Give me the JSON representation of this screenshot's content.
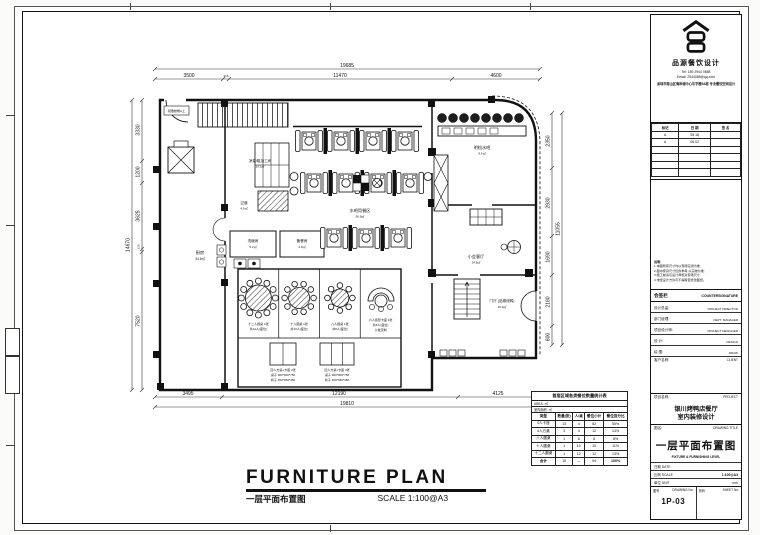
{
  "title_block": {
    "brand": {
      "name": "品源餐饮设计",
      "tel": "Tel: 189 2944 0888",
      "email": "Email: 2944088@qq.com",
      "address": "深圳市南山区海岸城中心写字楼5A栋 专业餐饮空间设计"
    },
    "revisions": {
      "headers": [
        "标记",
        "日 期",
        "签 名"
      ],
      "rows": [
        [
          "A",
          "05.18",
          ""
        ],
        [
          "A",
          "06.02",
          ""
        ]
      ]
    },
    "notes_title": "说明:",
    "notes": [
      "1.本图所有尺寸均以现场实测为准;",
      "2.图中家具尺寸仅供参考,以实物为准;",
      "3.施工前请与设计师核对现场尺寸;",
      "4.未经设计方许可不得擅自修改图纸。"
    ],
    "countersign": {
      "cn": "会签栏",
      "en": "COUNTERSIGNATURE"
    },
    "sign_rows": [
      [
        "设计总监:",
        "PROJECT DIRECTOR"
      ],
      [
        "部门经理:",
        "DEPT. MANAGER"
      ],
      [
        "项目设计师:",
        "PROJECT DESIGNER"
      ],
      [
        "设 计:",
        "DESIGN"
      ],
      [
        "绘 图:",
        "DRAW"
      ]
    ],
    "client_row": {
      "cn": "客户名称:",
      "en": "CLIENT"
    },
    "project_row": {
      "cn": "项目名称:",
      "en": "PROJECT"
    },
    "project_name_line1": "银川烤鸭店餐厅",
    "project_name_line2": "室内装修设计",
    "drawing_title_row": {
      "cn": "图名:",
      "en": "DRAWING TITLE"
    },
    "drawing_title_cn": "一层平面布置图",
    "drawing_title_en": "FIXTURE & FURNISHING LEVEL",
    "meta": [
      {
        "label": "日期 DATE",
        "value": ""
      },
      {
        "label": "比例 SCALE",
        "value": "1:100@A3"
      },
      {
        "label": "单位 UNIT",
        "value": "mm"
      }
    ],
    "drawing_no": {
      "cn": "图号",
      "en": "DRAWING No.",
      "value": "1P-03"
    },
    "sheet_no": {
      "cn": "页码",
      "en": "SHEET No.",
      "value": ""
    }
  },
  "footer": {
    "title": "FURNITURE PLAN",
    "subtitle_cn": "一层平面布置图",
    "scale": "SCALE  1:100@A3"
  },
  "plan": {
    "labels": {
      "stair_note": "疏散楼梯A上",
      "kitchen": "厨房",
      "kitchen_area": "34.6㎡",
      "cold": "凉菜/粗加工间",
      "cold_area": "10.1㎡",
      "corridor": "过道",
      "corridor_area": "4.6㎡",
      "dish": "洗碗间",
      "dish_area": "5.2㎡",
      "pantry": "备餐间",
      "pantry_area": "4.8㎡",
      "dining": "水吧用餐区",
      "dining_area": "56.9㎡",
      "bar": "明档水吧",
      "bar_area": "9.6㎡",
      "lounge": "小会客厅",
      "lounge_area": "14.6㎡",
      "foyer": "门厅 (品源烧鸭)",
      "foyer_area": "16.9㎡"
    },
    "dims": {
      "top_total": "19685",
      "top_segs": [
        "3500",
        "315",
        "11470",
        "4600"
      ],
      "bottom_total": "19810",
      "bottom_segs": [
        "3495",
        "12190",
        "4125"
      ],
      "left_total": "14670",
      "left_segs": [
        "3330",
        "1200",
        "3625",
        "130",
        "7520"
      ],
      "right_total": "11055",
      "right_segs": [
        "2350",
        "2930",
        "1690",
        "2180",
        "800"
      ]
    }
  },
  "legend": {
    "items": [
      {
        "l1": "十二人圆桌 1张",
        "l2": "共12人(座位)",
        "l3": ""
      },
      {
        "l1": "十人圆桌 1张",
        "l2": "共10人(座位)",
        "l3": ""
      },
      {
        "l1": "八人圆桌 1张",
        "l2": "共8人(座位)",
        "l3": ""
      },
      {
        "l1": "六人弧形卡座 1张",
        "l2": "共6人(座位)",
        "l3": "沙发定制"
      },
      {
        "l1": "四人方桌+卡座 2张",
        "l2": "桌子 900*900*750",
        "l3": "椅子 450*450*450"
      },
      {
        "l1": "四人方桌+卡座 3张",
        "l2": "桌子 900*900*750",
        "l3": "椅子 450*450*450"
      }
    ]
  },
  "stats": {
    "title": "首层区域各类餐位数量统计表",
    "area_row": "AREA:        ㎡",
    "indoor_row": "室内面积:        ㎡",
    "headers": [
      "类型",
      "数量(张)",
      "人/桌",
      "餐位小计",
      "餐位百分比"
    ],
    "rows": [
      [
        "4人卡座",
        "13",
        "4",
        "52",
        "55%"
      ],
      [
        "4人方桌",
        "3",
        "4",
        "12",
        "13%"
      ],
      [
        "八人圆桌",
        "1",
        "8",
        "8",
        "8%"
      ],
      [
        "十人圆桌",
        "1",
        "10",
        "10",
        "11%"
      ],
      [
        "十二人圆桌",
        "1",
        "12",
        "12",
        "13%"
      ]
    ],
    "total_row": [
      "合计",
      "19",
      "—",
      "94",
      "100%"
    ]
  }
}
